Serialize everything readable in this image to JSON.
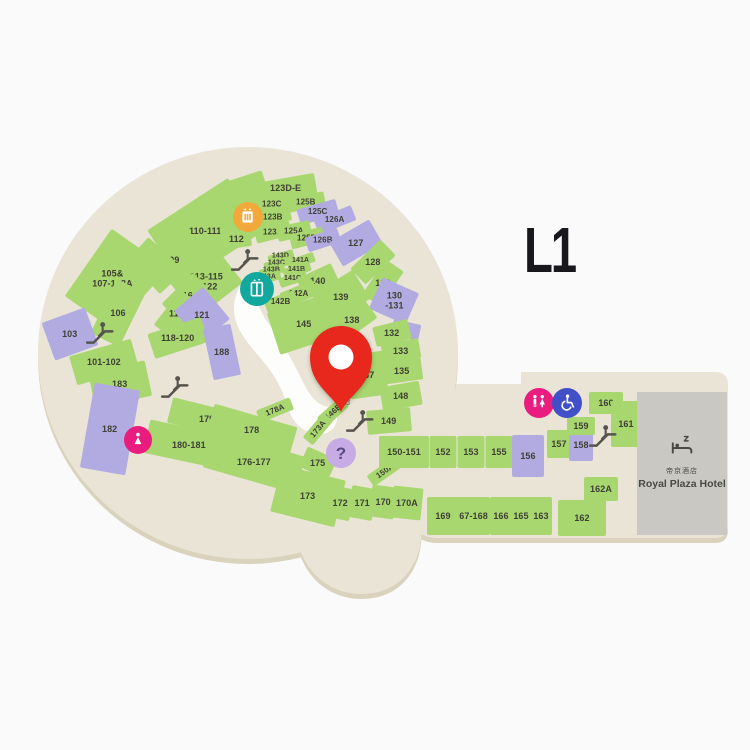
{
  "level_label": "L1",
  "hotel": {
    "name_zh": "帝京酒店",
    "name_en": "Royal Plaza Hotel"
  },
  "colors": {
    "beige": "#e9e4d5",
    "beige_shadow": "#d9d2bd",
    "green": "#a7d76e",
    "purple": "#b2abe1",
    "label": "#3f3f35",
    "hotel_gray": "#c9c8c2",
    "pin_red": "#e8281c",
    "icon_orange": "#f2a93b",
    "icon_teal": "#13a89e",
    "icon_pink": "#e91d7f",
    "icon_blue": "#4150c8",
    "icon_lilac": "#c6abe5",
    "escalator_gray": "#56554d"
  },
  "map": {
    "pin": {
      "x": 341,
      "y": 412
    },
    "shops": [
      {
        "label": "110-111",
        "x": 205,
        "y": 231,
        "w": 96,
        "h": 64,
        "r": -33
      },
      {
        "label": "",
        "x": 247,
        "y": 197,
        "w": 44,
        "h": 42,
        "r": -18
      },
      {
        "label": "109",
        "x": 172,
        "y": 260,
        "w": 64,
        "h": 34,
        "r": -42
      },
      {
        "label": "108",
        "x": 143,
        "y": 270,
        "w": 56,
        "h": 36,
        "r": -48
      },
      {
        "label": "105&\n107-108A",
        "x": 112,
        "y": 279,
        "w": 82,
        "h": 58,
        "r": -55
      },
      {
        "label": "106",
        "x": 118,
        "y": 313,
        "w": 60,
        "h": 32,
        "r": -64
      },
      {
        "label": "103",
        "x": 70,
        "y": 334,
        "w": 46,
        "h": 40,
        "r": -20,
        "c": "p"
      },
      {
        "label": "101-102",
        "x": 104,
        "y": 362,
        "w": 64,
        "h": 30,
        "r": -16
      },
      {
        "label": "183",
        "x": 120,
        "y": 384,
        "w": 58,
        "h": 36,
        "r": -12
      },
      {
        "label": "182",
        "x": 110,
        "y": 429,
        "w": 46,
        "h": 86,
        "r": 10,
        "c": "p"
      },
      {
        "label": "112",
        "x": 236,
        "y": 239,
        "w": 30,
        "h": 18,
        "r": -8
      },
      {
        "label": "113-115\n&122",
        "x": 206,
        "y": 282,
        "w": 58,
        "h": 46,
        "r": -38
      },
      {
        "label": "116",
        "x": 185,
        "y": 296,
        "w": 44,
        "h": 22,
        "r": -45
      },
      {
        "label": "117",
        "x": 176,
        "y": 314,
        "w": 44,
        "h": 22,
        "r": -52
      },
      {
        "label": "121",
        "x": 202,
        "y": 315,
        "w": 38,
        "h": 42,
        "r": -40,
        "c": "p"
      },
      {
        "label": "118-120",
        "x": 178,
        "y": 338,
        "w": 56,
        "h": 26,
        "r": -18
      },
      {
        "label": "188",
        "x": 222,
        "y": 352,
        "w": 28,
        "h": 52,
        "r": -12,
        "c": "p"
      },
      {
        "label": "123D-E",
        "x": 286,
        "y": 188,
        "w": 60,
        "h": 20,
        "r": -10
      },
      {
        "label": "123C",
        "x": 272,
        "y": 204,
        "w": 36,
        "h": 15,
        "r": -14,
        "fs": 8
      },
      {
        "label": "125B",
        "x": 306,
        "y": 202,
        "w": 38,
        "h": 15,
        "r": -10,
        "fs": 8
      },
      {
        "label": "123B",
        "x": 273,
        "y": 217,
        "w": 36,
        "h": 15,
        "r": -14,
        "fs": 8
      },
      {
        "label": "125C",
        "x": 318,
        "y": 212,
        "w": 40,
        "h": 16,
        "r": -16,
        "c": "p",
        "fs": 8
      },
      {
        "label": "126A",
        "x": 335,
        "y": 220,
        "w": 40,
        "h": 16,
        "r": -22,
        "c": "p",
        "fs": 8
      },
      {
        "label": "123A",
        "x": 273,
        "y": 232,
        "w": 36,
        "h": 15,
        "r": -14,
        "fs": 8
      },
      {
        "label": "125A",
        "x": 294,
        "y": 231,
        "w": 34,
        "h": 15,
        "r": -12,
        "fs": 8
      },
      {
        "label": "125D",
        "x": 307,
        "y": 238,
        "w": 34,
        "h": 15,
        "r": -14,
        "fs": 8
      },
      {
        "label": "126B",
        "x": 323,
        "y": 240,
        "w": 34,
        "h": 15,
        "r": -18,
        "c": "p",
        "fs": 8
      },
      {
        "label": "127",
        "x": 356,
        "y": 243,
        "w": 46,
        "h": 28,
        "r": -30,
        "c": "p"
      },
      {
        "label": "128",
        "x": 373,
        "y": 262,
        "w": 42,
        "h": 22,
        "r": -44
      },
      {
        "label": "129",
        "x": 383,
        "y": 283,
        "w": 42,
        "h": 22,
        "r": -56
      },
      {
        "label": "130\n-131",
        "x": 394,
        "y": 301,
        "w": 34,
        "h": 40,
        "r": -66,
        "c": "p"
      },
      {
        "label": "",
        "x": 406,
        "y": 330,
        "w": 16,
        "h": 28,
        "r": -78,
        "c": "p"
      },
      {
        "label": "143D",
        "x": 281,
        "y": 257,
        "w": 26,
        "h": 9,
        "r": -16,
        "fs": 7
      },
      {
        "label": "143C",
        "x": 277,
        "y": 264,
        "w": 26,
        "h": 9,
        "r": -16,
        "fs": 7
      },
      {
        "label": "143B",
        "x": 272,
        "y": 271,
        "w": 26,
        "h": 9,
        "r": -16,
        "fs": 7
      },
      {
        "label": "143A",
        "x": 268,
        "y": 278,
        "w": 26,
        "h": 9,
        "r": -16,
        "fs": 7
      },
      {
        "label": "141A",
        "x": 301,
        "y": 261,
        "w": 28,
        "h": 10,
        "r": -18,
        "fs": 7
      },
      {
        "label": "141B",
        "x": 297,
        "y": 270,
        "w": 28,
        "h": 10,
        "r": -18,
        "fs": 7
      },
      {
        "label": "141C",
        "x": 293,
        "y": 279,
        "w": 28,
        "h": 10,
        "r": -18,
        "fs": 7
      },
      {
        "label": "140",
        "x": 318,
        "y": 281,
        "w": 38,
        "h": 22,
        "r": -25
      },
      {
        "label": "142A",
        "x": 299,
        "y": 294,
        "w": 36,
        "h": 16,
        "r": -22,
        "fs": 8
      },
      {
        "label": "142B",
        "x": 281,
        "y": 302,
        "w": 32,
        "h": 14,
        "r": -20,
        "fs": 8
      },
      {
        "label": "145",
        "x": 304,
        "y": 324,
        "w": 64,
        "h": 44,
        "r": -18
      },
      {
        "label": "139",
        "x": 341,
        "y": 297,
        "w": 48,
        "h": 34,
        "r": -32
      },
      {
        "label": "138",
        "x": 352,
        "y": 320,
        "w": 44,
        "h": 26,
        "r": -36
      },
      {
        "label": "147",
        "x": 367,
        "y": 375,
        "w": 38,
        "h": 44,
        "r": -8
      },
      {
        "label": "146E",
        "x": 333,
        "y": 412,
        "w": 32,
        "h": 13,
        "r": -42,
        "lr": -42,
        "fs": 8
      },
      {
        "label": "132",
        "x": 392,
        "y": 333,
        "w": 36,
        "h": 20,
        "r": -14
      },
      {
        "label": "133",
        "x": 401,
        "y": 351,
        "w": 38,
        "h": 20,
        "r": -10
      },
      {
        "label": "135",
        "x": 402,
        "y": 371,
        "w": 40,
        "h": 22,
        "r": -8
      },
      {
        "label": "148",
        "x": 401,
        "y": 396,
        "w": 40,
        "h": 24,
        "r": -10
      },
      {
        "label": "149",
        "x": 389,
        "y": 421,
        "w": 44,
        "h": 24,
        "r": -5
      },
      {
        "label": "178A",
        "x": 275,
        "y": 410,
        "w": 36,
        "h": 13,
        "r": -22,
        "lr": -22,
        "fs": 8
      },
      {
        "label": "173A",
        "x": 318,
        "y": 429,
        "w": 32,
        "h": 13,
        "r": -50,
        "lr": -50,
        "fs": 8
      },
      {
        "label": "150A",
        "x": 385,
        "y": 471,
        "w": 36,
        "h": 13,
        "r": -35,
        "lr": -35,
        "fs": 8
      },
      {
        "label": "179",
        "x": 207,
        "y": 419,
        "w": 76,
        "h": 26,
        "r": 14
      },
      {
        "label": "178",
        "x": 252,
        "y": 430,
        "w": 86,
        "h": 30,
        "r": 16
      },
      {
        "label": "180-181",
        "x": 189,
        "y": 445,
        "w": 86,
        "h": 34,
        "r": 12
      },
      {
        "label": "176-177",
        "x": 254,
        "y": 462,
        "w": 96,
        "h": 38,
        "r": 16
      },
      {
        "label": "175",
        "x": 318,
        "y": 463,
        "w": 32,
        "h": 22,
        "r": 24
      },
      {
        "label": "173",
        "x": 308,
        "y": 496,
        "w": 66,
        "h": 48,
        "r": 14
      },
      {
        "label": "172",
        "x": 340,
        "y": 503,
        "w": 25,
        "h": 32,
        "r": 12
      },
      {
        "label": "171",
        "x": 362,
        "y": 503,
        "w": 25,
        "h": 32,
        "r": 10
      },
      {
        "label": "170",
        "x": 383,
        "y": 502,
        "w": 25,
        "h": 32,
        "r": 8
      },
      {
        "label": "170A",
        "x": 407,
        "y": 503,
        "w": 30,
        "h": 32,
        "r": 6
      },
      {
        "label": "150-151",
        "x": 404,
        "y": 452,
        "w": 50,
        "h": 32,
        "r": 0
      },
      {
        "label": "152",
        "x": 443,
        "y": 452,
        "w": 27,
        "h": 32,
        "r": 0
      },
      {
        "label": "153",
        "x": 471,
        "y": 452,
        "w": 27,
        "h": 32,
        "r": 0
      },
      {
        "label": "155",
        "x": 499,
        "y": 452,
        "w": 27,
        "h": 32,
        "r": 0
      },
      {
        "label": "156",
        "x": 528,
        "y": 456,
        "w": 32,
        "h": 42,
        "r": 0,
        "c": "p"
      },
      {
        "label": "157",
        "x": 559,
        "y": 444,
        "w": 24,
        "h": 28,
        "r": 0
      },
      {
        "label": "158",
        "x": 581,
        "y": 445,
        "w": 24,
        "h": 32,
        "r": 0,
        "c": "p"
      },
      {
        "label": "159",
        "x": 581,
        "y": 426,
        "w": 28,
        "h": 18,
        "r": 0
      },
      {
        "label": "160",
        "x": 606,
        "y": 403,
        "w": 34,
        "h": 22,
        "r": 0
      },
      {
        "label": "161",
        "x": 626,
        "y": 424,
        "w": 30,
        "h": 46,
        "r": 0
      },
      {
        "label": "162A",
        "x": 601,
        "y": 489,
        "w": 34,
        "h": 24,
        "r": 0
      },
      {
        "label": "162",
        "x": 582,
        "y": 518,
        "w": 48,
        "h": 36,
        "r": 0
      },
      {
        "label": "163",
        "x": 541,
        "y": 516,
        "w": 22,
        "h": 38,
        "r": 0
      },
      {
        "label": "165",
        "x": 521,
        "y": 516,
        "w": 22,
        "h": 38,
        "r": 0
      },
      {
        "label": "166",
        "x": 501,
        "y": 516,
        "w": 22,
        "h": 38,
        "r": 0
      },
      {
        "label": "167-168",
        "x": 471,
        "y": 516,
        "w": 38,
        "h": 38,
        "r": 0
      },
      {
        "label": "169",
        "x": 443,
        "y": 516,
        "w": 32,
        "h": 38,
        "r": 0
      }
    ],
    "icons": [
      {
        "name": "service-machine-icon",
        "x": 248,
        "y": 217,
        "d": 30,
        "bg": "#f2a93b",
        "sym": "sym-machine"
      },
      {
        "name": "lift-icon",
        "x": 257,
        "y": 289,
        "d": 34,
        "bg": "#13a89e",
        "sym": "sym-lift"
      },
      {
        "name": "baby-care-icon",
        "x": 138,
        "y": 440,
        "d": 28,
        "bg": "#e91d7f",
        "sym": "sym-baby"
      },
      {
        "name": "information-icon",
        "x": 341,
        "y": 453,
        "d": 30,
        "bg": "#c6abe5",
        "glyph": "?"
      },
      {
        "name": "toilet-icon",
        "x": 539,
        "y": 403,
        "d": 30,
        "bg": "#e91d7f",
        "sym": "sym-toilets"
      },
      {
        "name": "accessible-toilet-icon",
        "x": 567,
        "y": 403,
        "d": 30,
        "bg": "#4150c8",
        "sym": "sym-wheelchair"
      }
    ],
    "escalators": [
      {
        "x": 245,
        "y": 260
      },
      {
        "x": 100,
        "y": 333
      },
      {
        "x": 175,
        "y": 387
      },
      {
        "x": 360,
        "y": 421,
        "note": "L3"
      },
      {
        "x": 603,
        "y": 436
      }
    ]
  }
}
